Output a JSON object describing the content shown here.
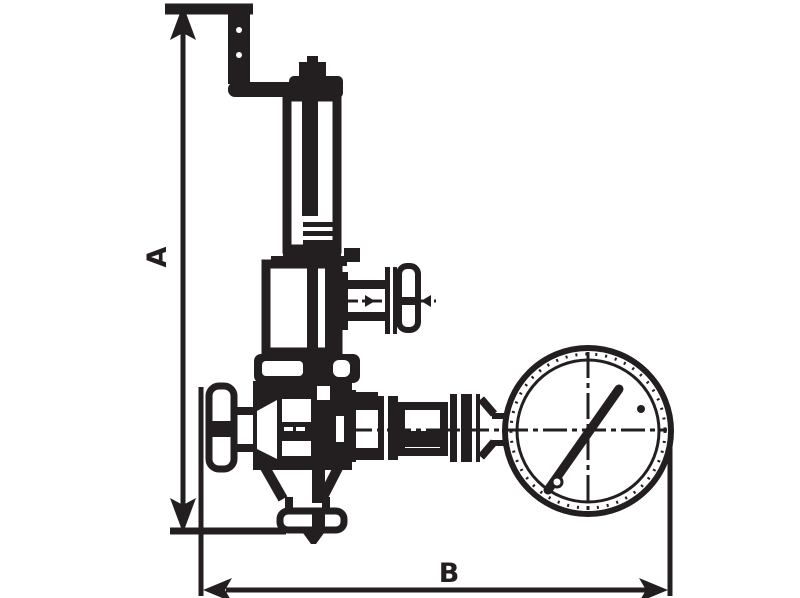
{
  "labels": {
    "dim_a": "A",
    "dim_b": "B"
  },
  "colors": {
    "ink": "#231f20",
    "background": "#ffffff"
  }
}
